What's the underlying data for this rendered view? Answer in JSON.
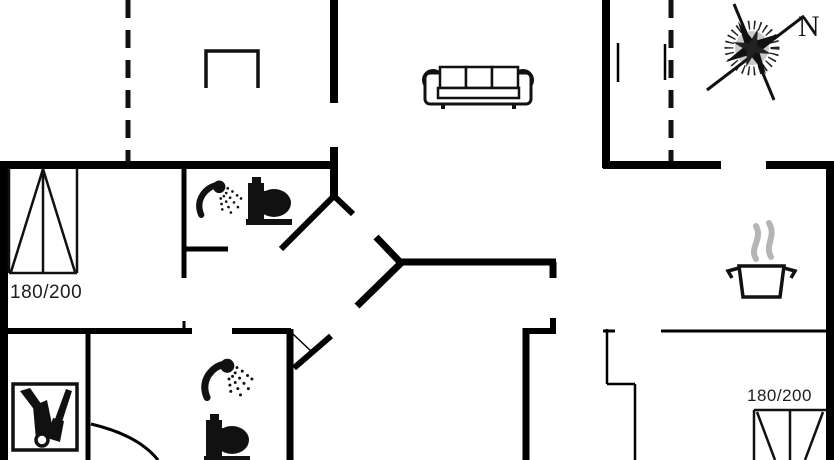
{
  "compass": {
    "north_label": "N"
  },
  "beds": [
    {
      "size_label": "180/200",
      "location": "left-bedroom"
    },
    {
      "size_label": "180/200",
      "location": "bottom-right-bedroom"
    }
  ],
  "icons": [
    "compass-rose",
    "sofa",
    "wardrobe-table",
    "shower-head",
    "toilet",
    "cooking-pot-with-steam",
    "cleaning-closet",
    "double-bed",
    "door-swing-arc"
  ],
  "colors": {
    "wall": "#000000",
    "icon": "#111111",
    "steam": "#b5b5b5",
    "text": "#1d1d1d",
    "background": "#ffffff"
  }
}
